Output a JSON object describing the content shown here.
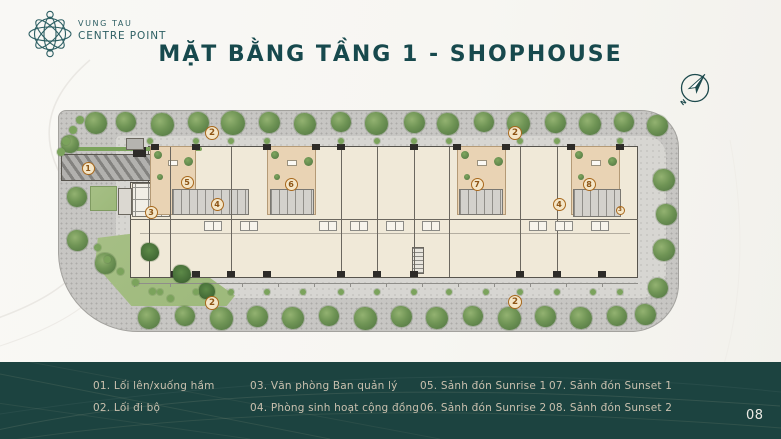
{
  "brand": {
    "line1": "VUNG TAU",
    "line2": "CENTRE POINT"
  },
  "title": "MẶT BẰNG TẦNG 1 - SHOPHOUSE",
  "page_number": "08",
  "compass": {
    "north_label": "N"
  },
  "legend": {
    "items": [
      {
        "num": "01",
        "label": "Lối lên/xuống hầm"
      },
      {
        "num": "02",
        "label": "Lối đi bộ"
      },
      {
        "num": "03",
        "label": "Văn phòng Ban quản lý"
      },
      {
        "num": "04",
        "label": "Phòng sinh hoạt cộng đồng"
      },
      {
        "num": "05",
        "label": "Sảnh đón Sunrise 1"
      },
      {
        "num": "06",
        "label": "Sảnh đón Sunrise 2"
      },
      {
        "num": "07",
        "label": "Sảnh đón Sunset 1"
      },
      {
        "num": "08",
        "label": "Sảnh đón Sunset 2"
      }
    ]
  },
  "plan": {
    "markers": [
      {
        "n": "1",
        "x": 88,
        "y": 168
      },
      {
        "n": "2",
        "x": 212,
        "y": 133,
        "s": 14
      },
      {
        "n": "2",
        "x": 515,
        "y": 133,
        "s": 14
      },
      {
        "n": "2",
        "x": 212,
        "y": 303,
        "s": 14
      },
      {
        "n": "2",
        "x": 515,
        "y": 302,
        "s": 14
      },
      {
        "n": "3",
        "x": 151,
        "y": 212
      },
      {
        "n": "3",
        "x": 620,
        "y": 210,
        "s": 9
      },
      {
        "n": "4",
        "x": 217,
        "y": 204
      },
      {
        "n": "4",
        "x": 559,
        "y": 204
      },
      {
        "n": "5",
        "x": 187,
        "y": 182
      },
      {
        "n": "6",
        "x": 291,
        "y": 184
      },
      {
        "n": "7",
        "x": 477,
        "y": 184
      },
      {
        "n": "8",
        "x": 589,
        "y": 184
      }
    ],
    "trees": [
      [
        96,
        123,
        22
      ],
      [
        126,
        122,
        20
      ],
      [
        162,
        124,
        23
      ],
      [
        198,
        122,
        21
      ],
      [
        233,
        123,
        24
      ],
      [
        269,
        122,
        21
      ],
      [
        305,
        124,
        22
      ],
      [
        341,
        122,
        20
      ],
      [
        376,
        123,
        23
      ],
      [
        414,
        122,
        21
      ],
      [
        448,
        124,
        22
      ],
      [
        484,
        122,
        20
      ],
      [
        518,
        123,
        23
      ],
      [
        555,
        122,
        21
      ],
      [
        590,
        124,
        22
      ],
      [
        624,
        122,
        20
      ],
      [
        657,
        125,
        21
      ],
      [
        149,
        318,
        22
      ],
      [
        185,
        316,
        20
      ],
      [
        221,
        318,
        23
      ],
      [
        257,
        316,
        21
      ],
      [
        293,
        318,
        22
      ],
      [
        329,
        316,
        20
      ],
      [
        365,
        318,
        23
      ],
      [
        401,
        316,
        21
      ],
      [
        437,
        318,
        22
      ],
      [
        473,
        316,
        20
      ],
      [
        509,
        318,
        23
      ],
      [
        545,
        316,
        21
      ],
      [
        581,
        318,
        22
      ],
      [
        617,
        316,
        20
      ],
      [
        645,
        314,
        21
      ],
      [
        664,
        180,
        22
      ],
      [
        666,
        214,
        21
      ],
      [
        664,
        250,
        22
      ],
      [
        658,
        288,
        20
      ],
      [
        70,
        144,
        18
      ],
      [
        77,
        197,
        20
      ],
      [
        77,
        240,
        21
      ],
      [
        105,
        263,
        21
      ],
      [
        150,
        252,
        18,
        "palm"
      ],
      [
        182,
        274,
        18,
        "palm"
      ],
      [
        207,
        291,
        16,
        "palm"
      ]
    ],
    "tufts": [
      [
        80,
        120,
        8
      ],
      [
        73,
        130,
        8
      ],
      [
        66,
        141,
        8
      ],
      [
        61,
        152,
        8
      ],
      [
        97,
        247,
        7
      ],
      [
        107,
        259,
        7
      ],
      [
        120,
        271,
        7
      ],
      [
        135,
        282,
        7
      ],
      [
        152,
        291,
        7
      ],
      [
        170,
        298,
        7
      ],
      [
        150,
        141,
        6
      ],
      [
        196,
        141,
        6
      ],
      [
        231,
        141,
        6
      ],
      [
        267,
        141,
        6
      ],
      [
        341,
        141,
        6
      ],
      [
        377,
        141,
        6
      ],
      [
        414,
        141,
        6
      ],
      [
        449,
        141,
        6
      ],
      [
        520,
        141,
        6
      ],
      [
        557,
        141,
        6
      ],
      [
        620,
        141,
        6
      ],
      [
        160,
        292,
        6
      ],
      [
        196,
        292,
        6
      ],
      [
        231,
        292,
        6
      ],
      [
        267,
        292,
        6
      ],
      [
        303,
        292,
        6
      ],
      [
        341,
        292,
        6
      ],
      [
        377,
        292,
        6
      ],
      [
        414,
        292,
        6
      ],
      [
        449,
        292,
        6
      ],
      [
        486,
        292,
        6
      ],
      [
        520,
        292,
        6
      ],
      [
        557,
        292,
        6
      ],
      [
        593,
        292,
        6
      ],
      [
        620,
        292,
        6
      ]
    ],
    "dividers": [
      170,
      231,
      341,
      377,
      414,
      449,
      520,
      557
    ],
    "ticks_top": [
      155,
      196,
      267,
      316,
      341,
      414,
      457,
      506,
      571,
      620
    ],
    "ticks_bottom": [
      175,
      196,
      231,
      267,
      341,
      377,
      414,
      520,
      557,
      602
    ],
    "lobbies": [
      {
        "x": 150,
        "w": 46
      },
      {
        "x": 267,
        "w": 49
      },
      {
        "x": 457,
        "w": 49
      },
      {
        "x": 571,
        "w": 49
      }
    ],
    "cores": [
      {
        "x": 172,
        "y": 189,
        "w": 77,
        "h": 26
      },
      {
        "x": 270,
        "y": 189,
        "w": 44,
        "h": 26
      },
      {
        "x": 459,
        "y": 189,
        "w": 44,
        "h": 26
      },
      {
        "x": 573,
        "y": 189,
        "w": 48,
        "h": 28
      }
    ],
    "fixtures": [
      213,
      249,
      328,
      359,
      395,
      431,
      538,
      564,
      600
    ]
  },
  "colors": {
    "teal": "#17494d",
    "brand": "#2d5f63",
    "legend_bg": "#1c4340",
    "legend_text": "#c9c0ae",
    "page_bg": "#f7f6f2",
    "paving": "#c7c6c3",
    "building": "#f0e9d8",
    "lobby": "#e9d3b4",
    "tree": "#6f9455",
    "lawn": "#9db97b",
    "marker_border": "#a8681c",
    "marker_fill": "#f4e6c8"
  }
}
